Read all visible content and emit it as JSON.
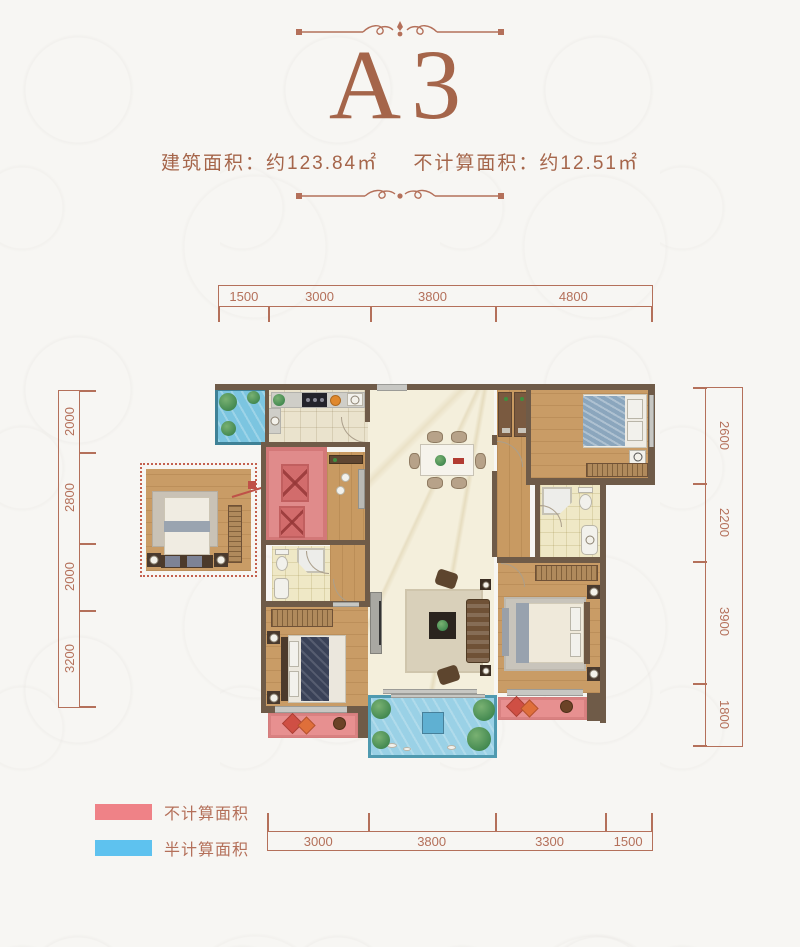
{
  "header": {
    "title": "A3",
    "built_area": "建筑面积：约123.84㎡",
    "excluded_area": "不计算面积：约12.51㎡"
  },
  "dimensions": {
    "top": [
      "1500",
      "3000",
      "3800",
      "4800"
    ],
    "bottom": [
      "3000",
      "3800",
      "3300",
      "1500"
    ],
    "left": [
      "2000",
      "2800",
      "2000",
      "3200"
    ],
    "right": [
      "2600",
      "2200",
      "3900",
      "1800"
    ]
  },
  "legend": {
    "items": [
      {
        "label": "不计算面积",
        "color": "#ef8287"
      },
      {
        "label": "半计算面积",
        "color": "#5ec2ef"
      }
    ]
  },
  "colors": {
    "accent_title": "#a5654a",
    "dimension_lines": "#b4705a",
    "walls": "#6f5b48",
    "red_uncounted_area": "#e08b8b",
    "blue_half_counted_area": "#9ad1e6",
    "wood_floor": "#c89a62",
    "marble_floor": "#f4efdc"
  },
  "icons": {
    "flourish": "ornamental-divider",
    "red_swatch": "uncounted-area-swatch",
    "blue_swatch": "half-counted-area-swatch"
  }
}
